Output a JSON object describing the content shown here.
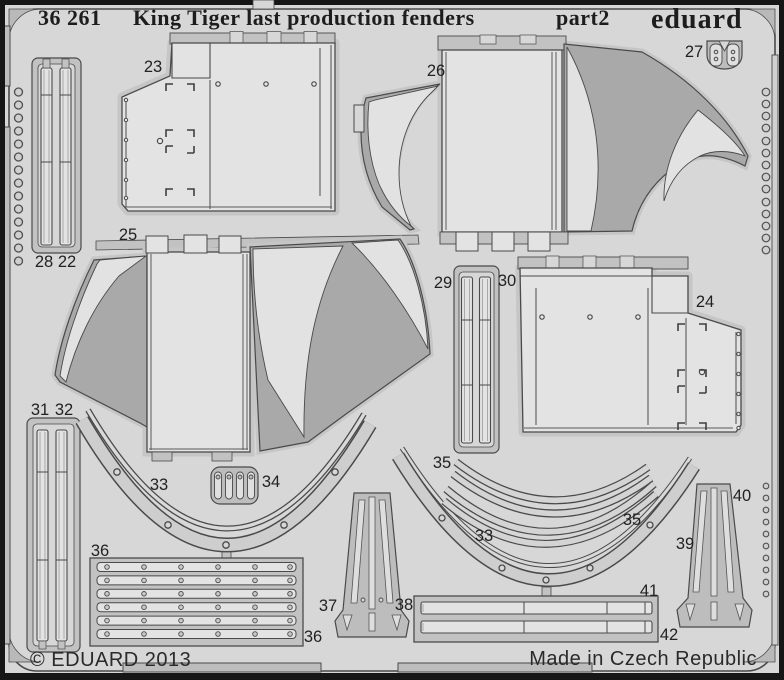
{
  "sheet": {
    "header": {
      "catalog_no": "36 261",
      "title": "King Tiger last production fenders",
      "part_suffix": "part2",
      "brand": "eduard"
    },
    "footer": {
      "copyright": "© EDUARD 2013",
      "origin": "Made in Czech Republic"
    },
    "colors": {
      "background": "#d7d7d7",
      "part_flat": "#e3e3e3",
      "part_shaded": "#a9a9a9",
      "rail": "#c2c2c2",
      "outline": "#4a4a4a",
      "border": "#161616",
      "text": "#1d1d1d"
    },
    "parts": {
      "p22": "22",
      "p23": "23",
      "p24": "24",
      "p25": "25",
      "p26": "26",
      "p27": "27",
      "p28": "28",
      "p29": "29",
      "p30": "30",
      "p31": "31",
      "p32": "32",
      "p33": "33",
      "p34": "34",
      "p35": "35",
      "p36": "36",
      "p37": "37",
      "p38": "38",
      "p39": "39",
      "p40": "40",
      "p41": "41",
      "p42": "42"
    }
  }
}
